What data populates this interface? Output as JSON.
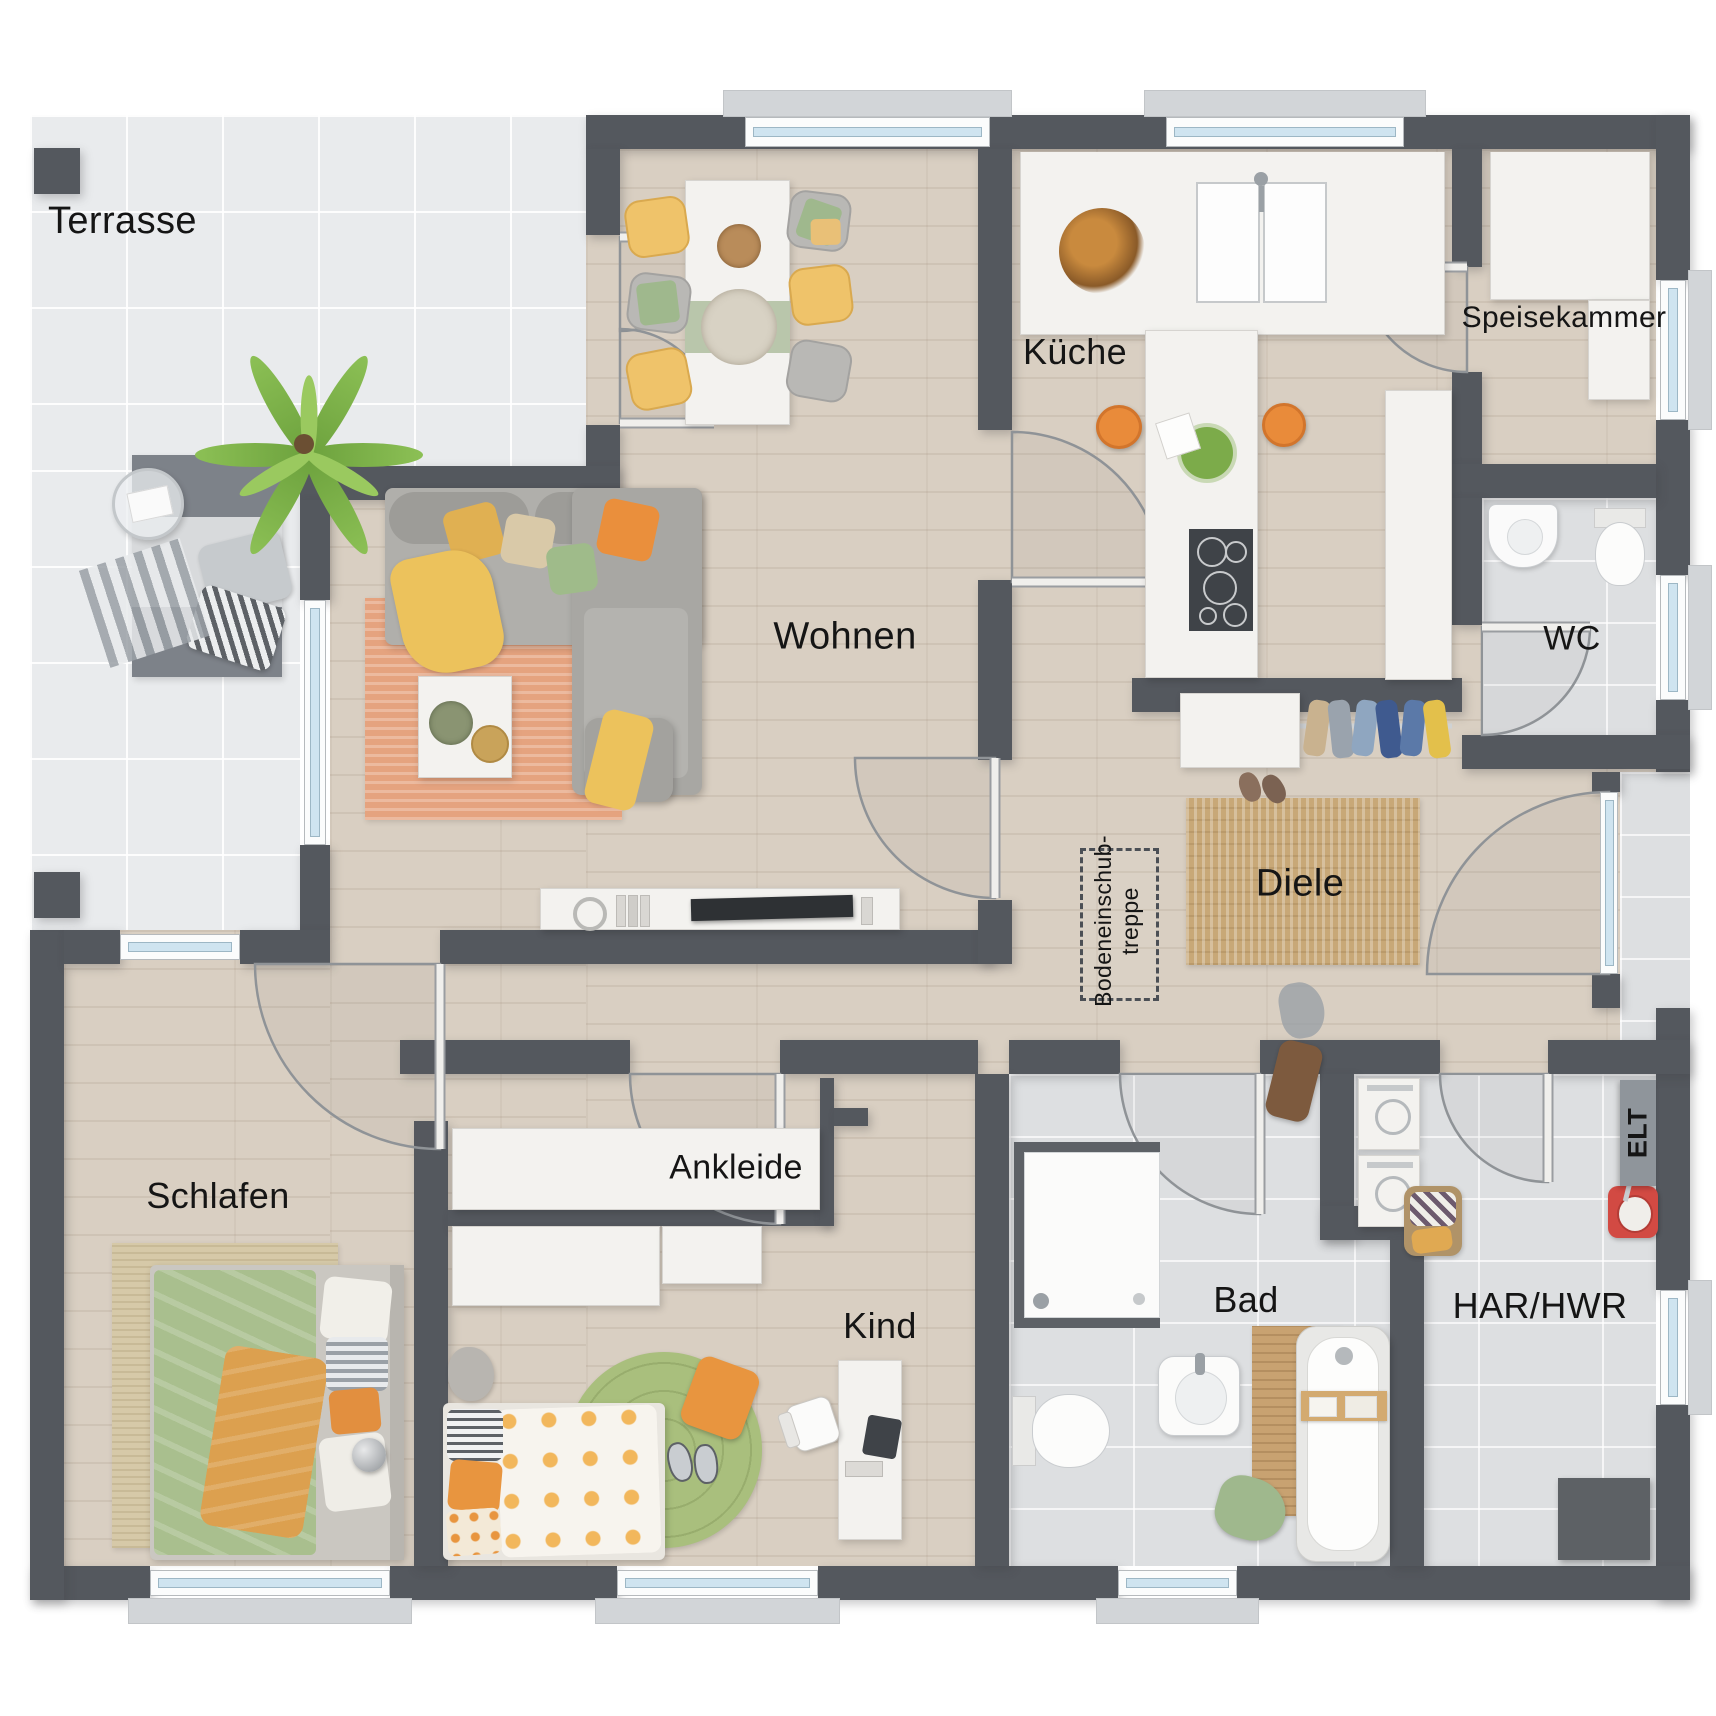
{
  "rooms": [
    {
      "id": "terrasse",
      "label": "Terrasse"
    },
    {
      "id": "kueche",
      "label": "Küche"
    },
    {
      "id": "speisekammer",
      "label": "Speisekammer"
    },
    {
      "id": "wc",
      "label": "WC"
    },
    {
      "id": "wohnen",
      "label": "Wohnen"
    },
    {
      "id": "diele",
      "label": "Diele"
    },
    {
      "id": "schlafen",
      "label": "Schlafen"
    },
    {
      "id": "ankleide",
      "label": "Ankleide"
    },
    {
      "id": "kind",
      "label": "Kind"
    },
    {
      "id": "bad",
      "label": "Bad"
    },
    {
      "id": "har_hwr",
      "label": "HAR/HWR"
    }
  ],
  "annotations": {
    "attic_stairs": {
      "line1": "Bodeneinschub-",
      "line2": "treppe"
    },
    "elt": "ELT"
  },
  "colors": {
    "wall": "#54585e",
    "wood_floor": "#d9cfc2",
    "terrace_tile": "#e9ebed",
    "bath_tile": "#dddfe1",
    "accent_orange": "#e98b3a",
    "accent_yellow": "#eec269",
    "accent_green": "#a9bf8e",
    "accent_salmon": "#e5a37f",
    "jute_rug": "#c8a877",
    "window_glass": "#cfe4f0"
  }
}
